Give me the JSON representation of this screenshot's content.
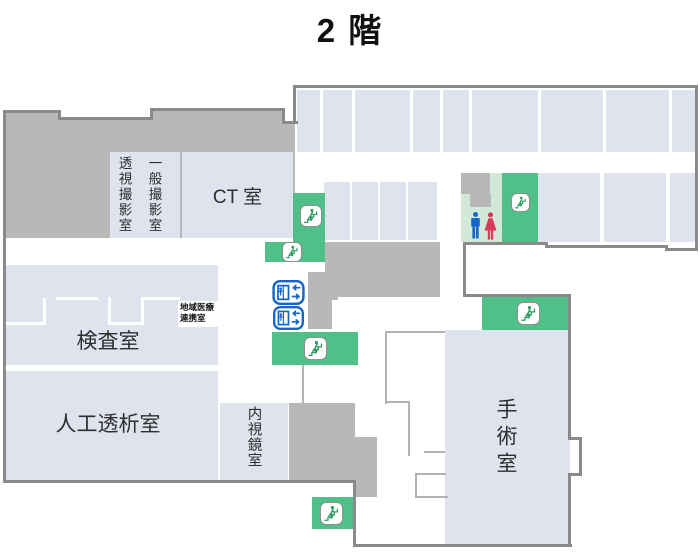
{
  "title": "2 階",
  "floor_map": {
    "rooms": {
      "general_xray": "一般撮影室",
      "fluoroscopy": "透視撮影室",
      "ct": "CT 室",
      "exam": "検査室",
      "regional_medical_line1": "地域医療",
      "regional_medical_line2": "連携室",
      "dialysis": "人工透析室",
      "endoscopy": "内視鏡室",
      "surgery": "手術室"
    },
    "icons": {
      "stairs": "stairs-icon",
      "elevator": "elevator-icon",
      "toilet_man": "toilet-man-icon",
      "toilet_woman": "toilet-woman-icon"
    },
    "colors": {
      "room_fill": "#dfe3ee",
      "corridor_gray": "#b8b8b8",
      "outline_gray": "#8a8a8a",
      "stairs_green": "#4fc088",
      "toilet_area_green": "#d2e9d8",
      "elevator_blue": "#1566c8",
      "toilet_man_blue": "#1566c8",
      "toilet_woman_red": "#d63c5c",
      "stair_figure_green": "#2a9a5f"
    }
  }
}
